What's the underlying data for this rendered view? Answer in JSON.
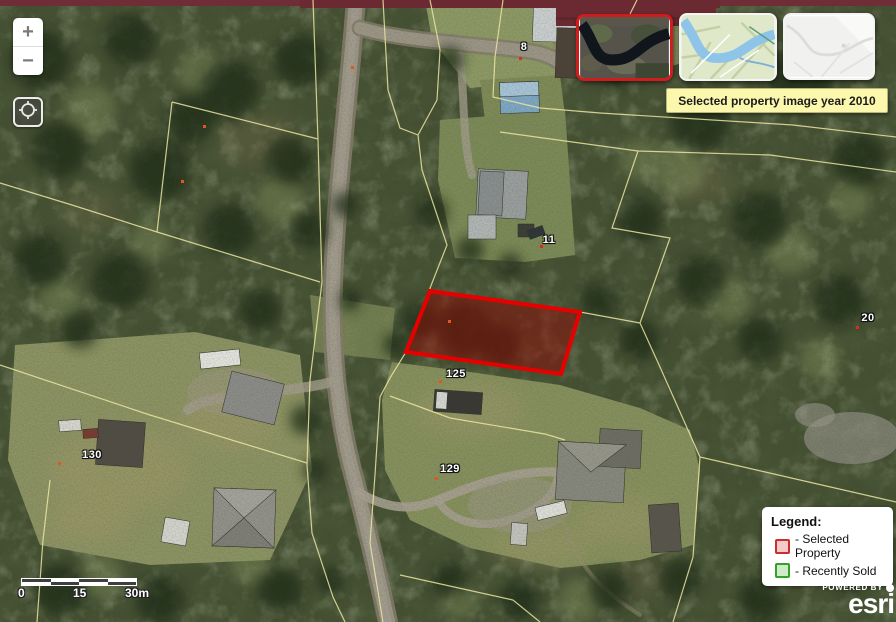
{
  "map": {
    "parcel_labels": [
      {
        "text": "8"
      },
      {
        "text": "11"
      },
      {
        "text": "20"
      },
      {
        "text": "125"
      },
      {
        "text": "129"
      },
      {
        "text": "130"
      }
    ],
    "selected_parcel": "125"
  },
  "controls": {
    "zoom_in_label": "+",
    "zoom_out_label": "−"
  },
  "basemap_picker": {
    "thumbnails": [
      {
        "icon": "aerial-imagery-thumbnail",
        "selected": true
      },
      {
        "icon": "street-map-thumbnail",
        "selected": false
      },
      {
        "icon": "light-gray-canvas-thumbnail",
        "selected": false
      }
    ]
  },
  "tooltip": {
    "text": "Selected property image year 2010"
  },
  "legend": {
    "title": "Legend:",
    "items": [
      {
        "label": "- Selected Property",
        "swatch_fill": "#f6caca",
        "swatch_border": "#c9302c"
      },
      {
        "label": "- Recently Sold",
        "swatch_fill": "#cdedc6",
        "swatch_border": "#36a02e"
      }
    ]
  },
  "scale_bar": {
    "labels": [
      "0",
      "15",
      "30m"
    ]
  },
  "attribution": {
    "powered_by": "POWERED BY",
    "brand": "esri"
  },
  "colors": {
    "selected_parcel_stroke": "#e60000",
    "selected_parcel_fill": "rgba(143,10,5,0.5)",
    "parcel_line": "#ece5a2",
    "parcel_point_orange": "#e0571f",
    "parcel_point_red": "#d92b20",
    "tooltip_bg": "#fbf7ad"
  }
}
